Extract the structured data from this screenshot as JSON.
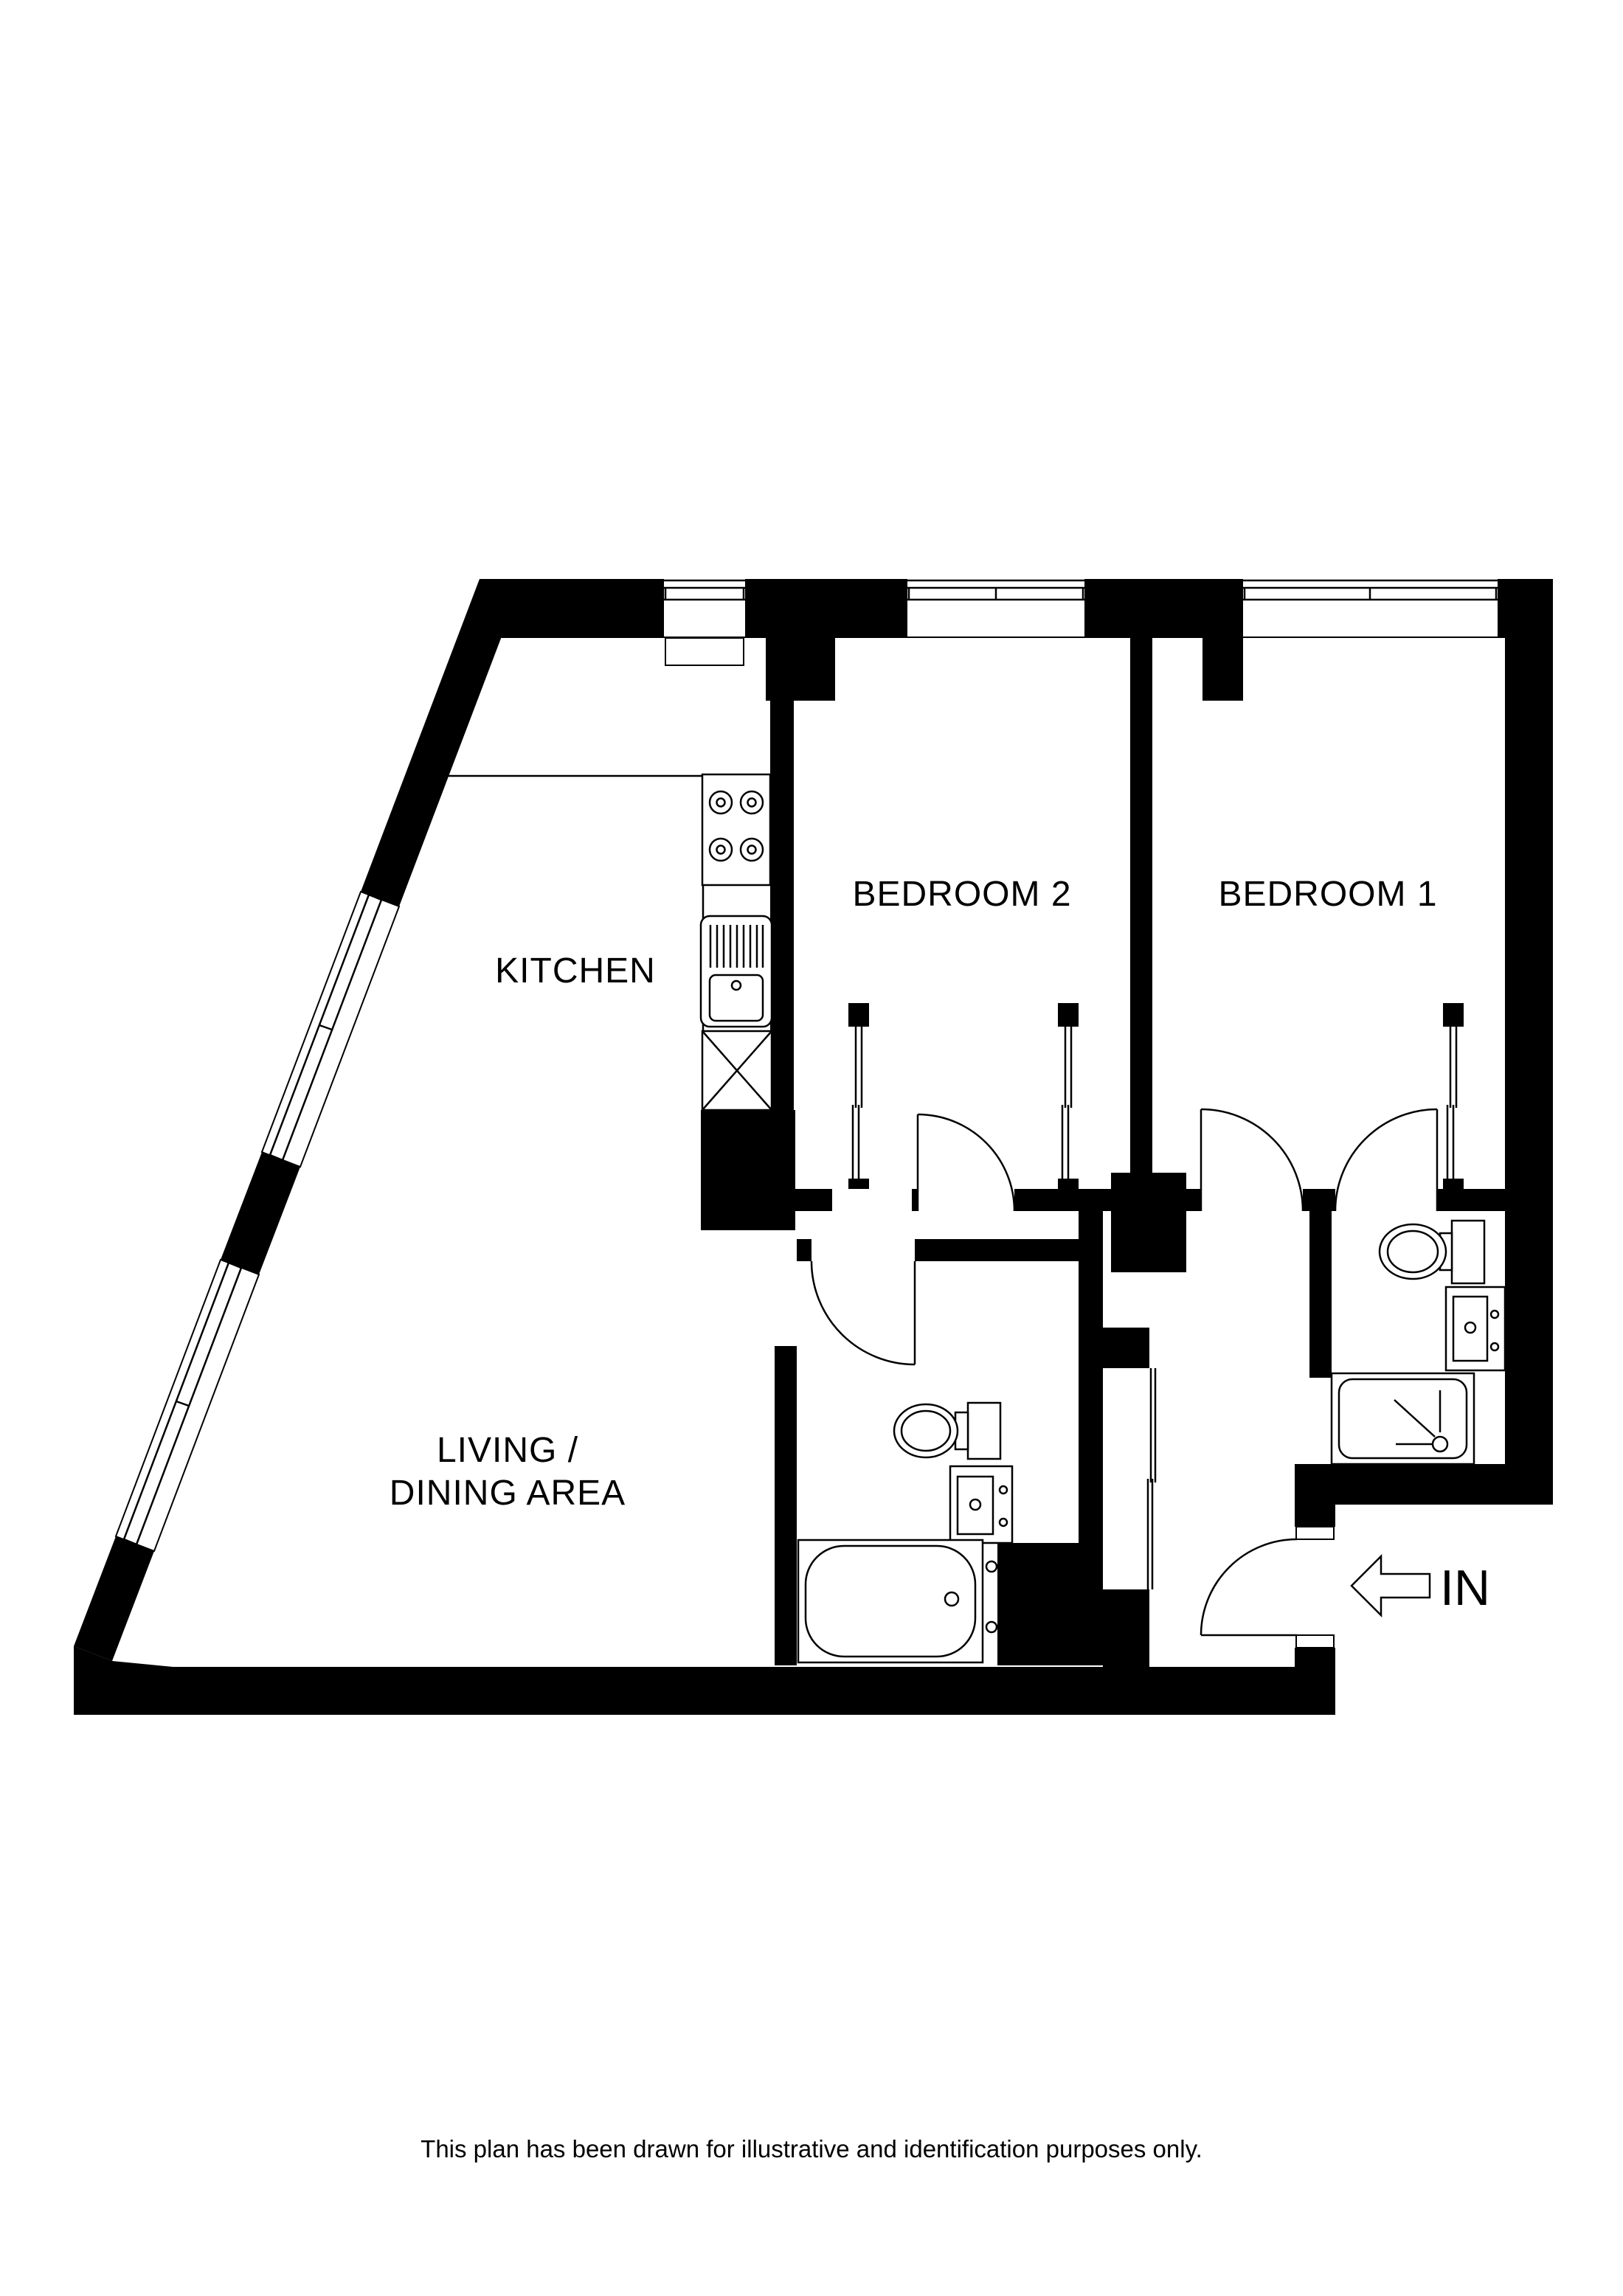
{
  "plan": {
    "type": "apartment-floor-plan",
    "wall_color": "#000000",
    "line_color": "#000000",
    "background": "#ffffff",
    "rooms": {
      "kitchen": {
        "label": "KITCHEN"
      },
      "bedroom2": {
        "label": "BEDROOM 2"
      },
      "bedroom1": {
        "label": "BEDROOM 1"
      },
      "living": {
        "label_line1": "LIVING /",
        "label_line2": "DINING AREA"
      }
    },
    "entrance": {
      "label": "IN",
      "arrow": "left-arrow"
    },
    "fixtures": [
      "hob-4-burners",
      "sink-with-drainer",
      "appliance-space-x",
      "bath-with-taps",
      "toilet-main-bathroom",
      "vanity-basin-main-bathroom",
      "toilet-ensuite",
      "vanity-basin-ensuite",
      "shower-ensuite",
      "built-in-wardrobe-bedroom2-west",
      "built-in-wardrobe-bedroom2-east",
      "built-in-wardrobe-bedroom1",
      "hall-cupboard-sliding-door",
      "windows-top-x3",
      "windows-diagonal-x2",
      "door-arcs-x5"
    ]
  },
  "footer": {
    "disclaimer": "This plan has been drawn for illustrative and identification purposes only."
  }
}
